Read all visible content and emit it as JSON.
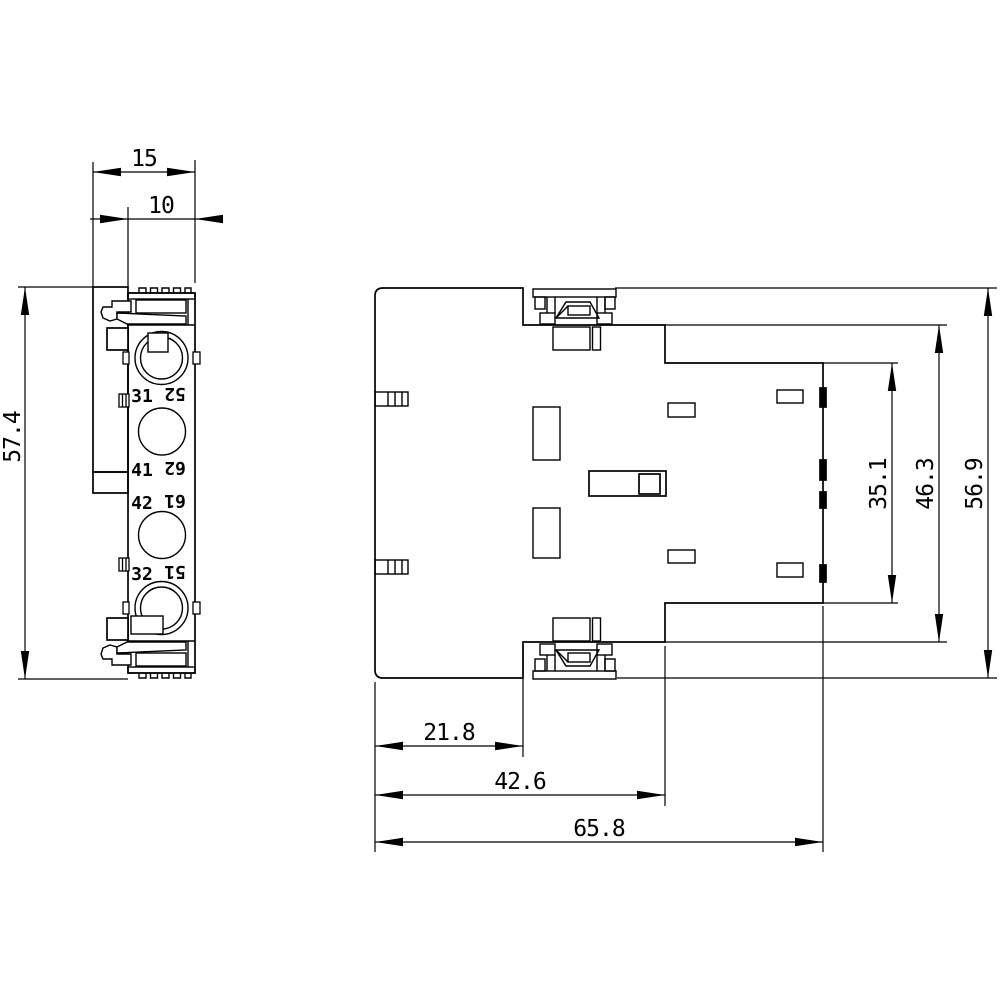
{
  "drawing": {
    "background": "#ffffff",
    "line_color": "#000000",
    "side_view": {
      "dim_width_outer": "15",
      "dim_width_body": "10",
      "dim_height": "57.4",
      "terminals": [
        {
          "left": "31",
          "right": "52"
        },
        {
          "left": "41",
          "right": "62"
        },
        {
          "left": "42",
          "right": "61"
        },
        {
          "left": "32",
          "right": "51"
        }
      ]
    },
    "front_view": {
      "dim_left_step": "21.8",
      "dim_mid_step": "42.6",
      "dim_total_width": "65.8",
      "dim_inner_height": "35.1",
      "dim_step_height": "46.3",
      "dim_total_height": "56.9"
    }
  }
}
